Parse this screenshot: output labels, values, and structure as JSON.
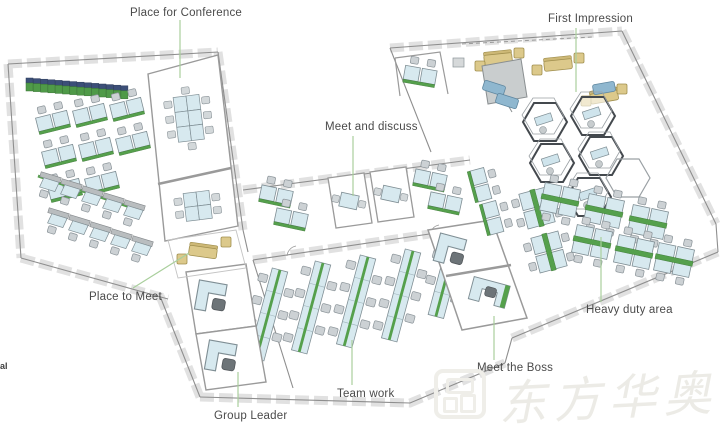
{
  "diagram": {
    "type": "isometric-office-floor-plan",
    "annotations": {
      "place_for_conference": "Place for Conference",
      "first_impression": "First Impression",
      "meet_and_discuss": "Meet and discuss",
      "place_to_meet": "Place to Meet",
      "group_leader": "Group Leader",
      "team_work": "Team work",
      "meet_the_boss": "Meet the Boss",
      "heavy_duty_area": "Heavy duty area",
      "edge_fragment": "al"
    },
    "watermark": {
      "logo": "seal-square-logo",
      "text": "东方华奥"
    },
    "colors": {
      "label_text": "#4a4a4a",
      "leader_line": "#a9cf9c",
      "desk_top": "#d7e9ef",
      "accent_green": "#55a04c",
      "locker_navy": "#3c4f78",
      "sofa_yellow": "#dcc98b",
      "sofa_blue": "#8fb7cf",
      "wall_gray": "#8e8e8e",
      "watermark_gray": "#ecebe6"
    }
  }
}
